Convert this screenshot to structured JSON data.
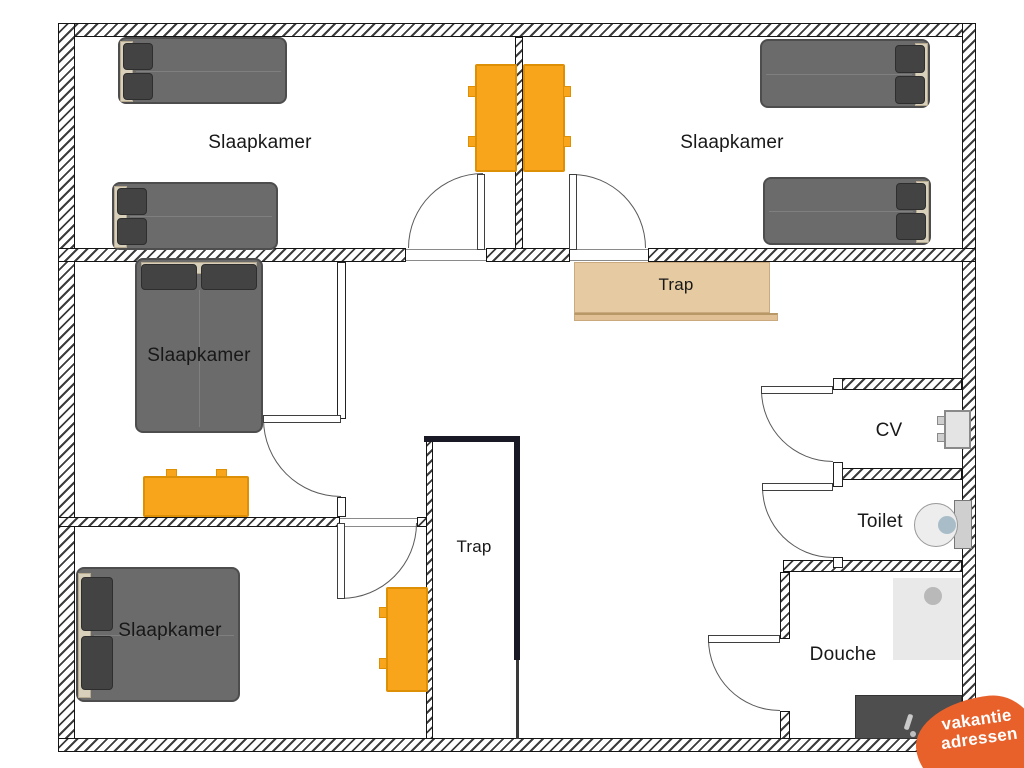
{
  "plan": {
    "rooms": [
      {
        "id": "bedroom-top-left",
        "label": "Slaapkamer"
      },
      {
        "id": "bedroom-top-right",
        "label": "Slaapkamer"
      },
      {
        "id": "bedroom-middle-left",
        "label": "Slaapkamer"
      },
      {
        "id": "bedroom-bottom-left",
        "label": "Slaapkamer"
      },
      {
        "id": "stairs-upper",
        "label": "Trap"
      },
      {
        "id": "stairwell-middle",
        "label": "Trap"
      },
      {
        "id": "cv-room",
        "label": "CV"
      },
      {
        "id": "toilet-room",
        "label": "Toilet"
      },
      {
        "id": "shower-room",
        "label": "Douche"
      }
    ],
    "furniture": [
      {
        "name": "double-bed",
        "count": 6
      },
      {
        "name": "desk-dresser",
        "count": 4
      },
      {
        "name": "wooden-staircase",
        "count": 1
      },
      {
        "name": "cv-boiler",
        "count": 1
      },
      {
        "name": "toilet-fixture",
        "count": 1
      },
      {
        "name": "shower-tray",
        "count": 1
      }
    ]
  },
  "logo": {
    "line1": "vakantie",
    "line2": "adressen"
  },
  "colors": {
    "desk_orange": "#F9A51C",
    "wood": "#E6CAA2",
    "bed_gray": "#6B6B6B",
    "logo_orange": "#E8612B",
    "stair_outline": "#191925"
  }
}
